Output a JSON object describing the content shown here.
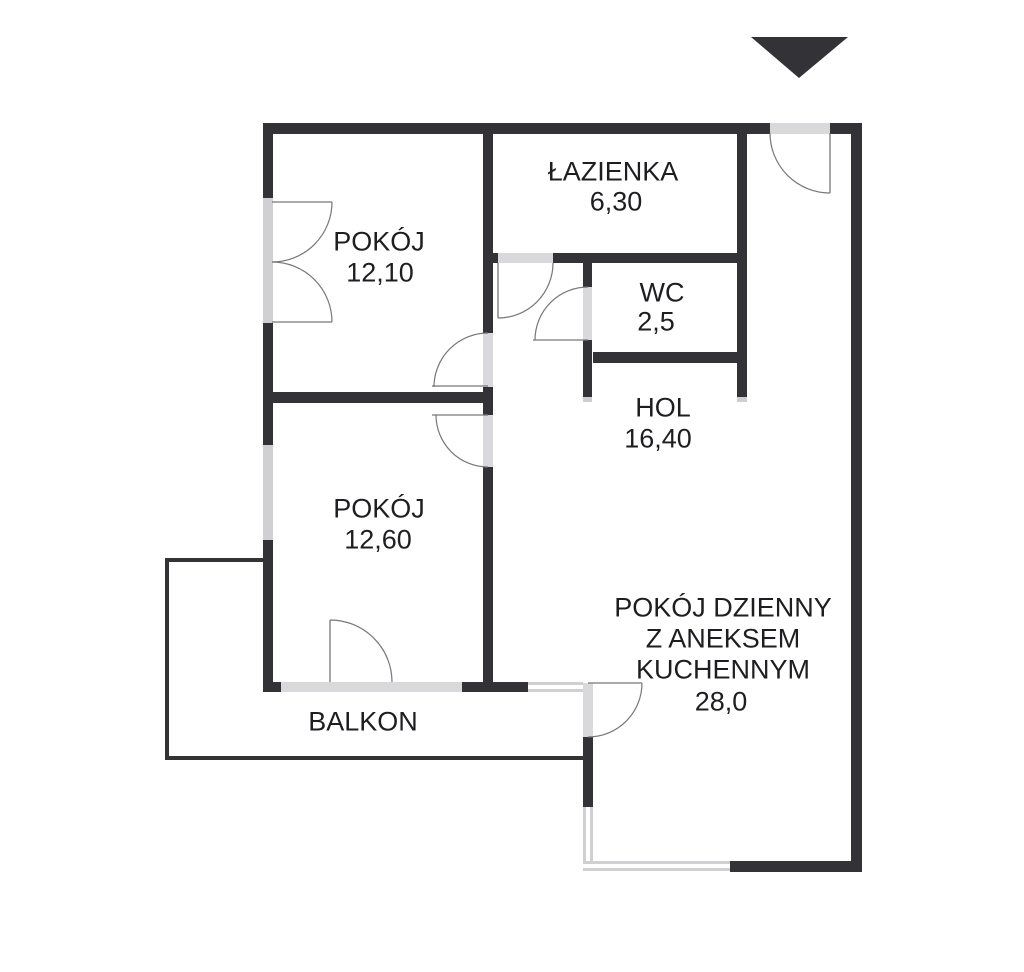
{
  "rooms": {
    "pokoj_gorny": {
      "name": "POKÓJ",
      "area": "12,10"
    },
    "lazienka": {
      "name": "ŁAZIENKA",
      "area": "6,30"
    },
    "wc": {
      "name": "WC",
      "area": "2,5"
    },
    "hol": {
      "name": "HOL",
      "area": "16,40"
    },
    "pokoj_dolny": {
      "name": "POKÓJ",
      "area": "12,60"
    },
    "pokoj_dzienny": {
      "name": "POKÓJ DZIENNY\nZ ANEKSEM\nKUCHENNYM",
      "area": "28,0"
    },
    "balkon": {
      "name": "BALKON"
    }
  },
  "colors": {
    "wall": "#323237",
    "opening": "#d9d9db",
    "window": "#d0d0d3",
    "text": "#1e1e22",
    "door_line": "#77777b"
  }
}
